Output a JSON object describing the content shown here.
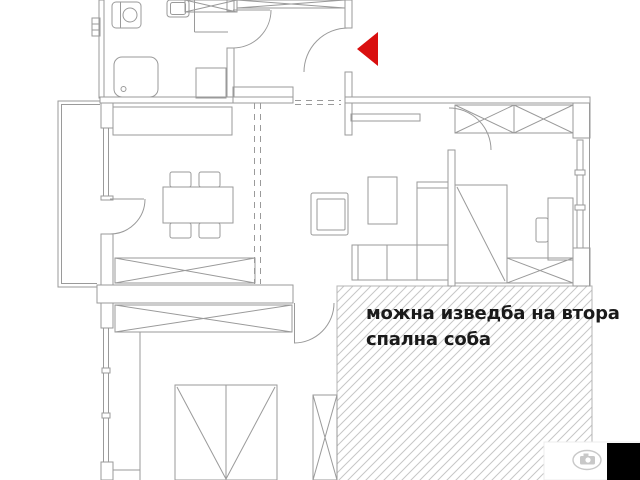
{
  "annotation": {
    "line1": "можна изведба на втора",
    "line2": "спална соба"
  },
  "colors": {
    "background": "#ffffff",
    "drawing_line": "#9a9a9a",
    "hatch_line": "#c6c6c6",
    "hatch_border": "#b5b5b5",
    "entrance_arrow": "#d90f0f",
    "annotation_text": "#1a1a1a",
    "corner_box": "#000000",
    "watermark_gray": "#c8c8c8"
  },
  "icons": {
    "entrance_arrow": "left-pointing-red-triangle",
    "watermark": "camera-in-ellipse"
  }
}
